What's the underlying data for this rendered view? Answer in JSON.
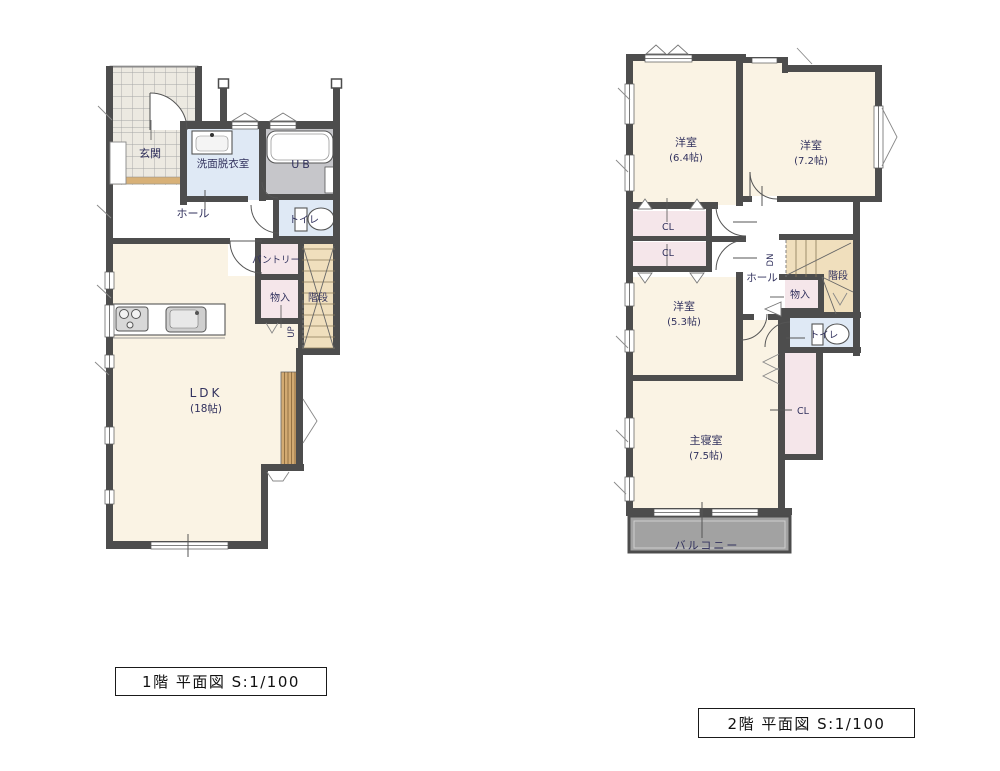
{
  "title": "間取り図 平面図",
  "colors": {
    "cream": "#faf3e4",
    "pink": "#f5e6ea",
    "blue": "#dfe9f5",
    "tan": "#f0dfbd",
    "wall": "#4d4d4d",
    "navy": "#32325e",
    "balcony": "#a2a2a2",
    "deck": "#d2aa72",
    "tile": "#ece9e1",
    "ub_floor": "#c6c6ca"
  },
  "floor1": {
    "caption": "1階 平面図 S:1/100",
    "labels": {
      "genkan": "玄関",
      "washroom": "洗面脱衣室",
      "ub": "UB",
      "hall": "ホール",
      "toilet": "トイレ",
      "pantry": "パントリー",
      "storage": "物入",
      "stairs": "階段",
      "up": "UP",
      "ldk": "LDK",
      "ldk_size": "(18帖)"
    }
  },
  "floor2": {
    "caption": "2階 平面図 S:1/100",
    "labels": {
      "room1": "洋室",
      "room1_size": "(6.4帖)",
      "room2": "洋室",
      "room2_size": "(7.2帖)",
      "room3": "洋室",
      "room3_size": "(5.3帖)",
      "master": "主寝室",
      "master_size": "(7.5帖)",
      "cl1": "CL",
      "cl2": "CL",
      "cl3": "CL",
      "hall": "ホール",
      "dn": "DN",
      "stairs": "階段",
      "storage": "物入",
      "toilet": "トイレ",
      "balcony": "バルコニー"
    }
  }
}
